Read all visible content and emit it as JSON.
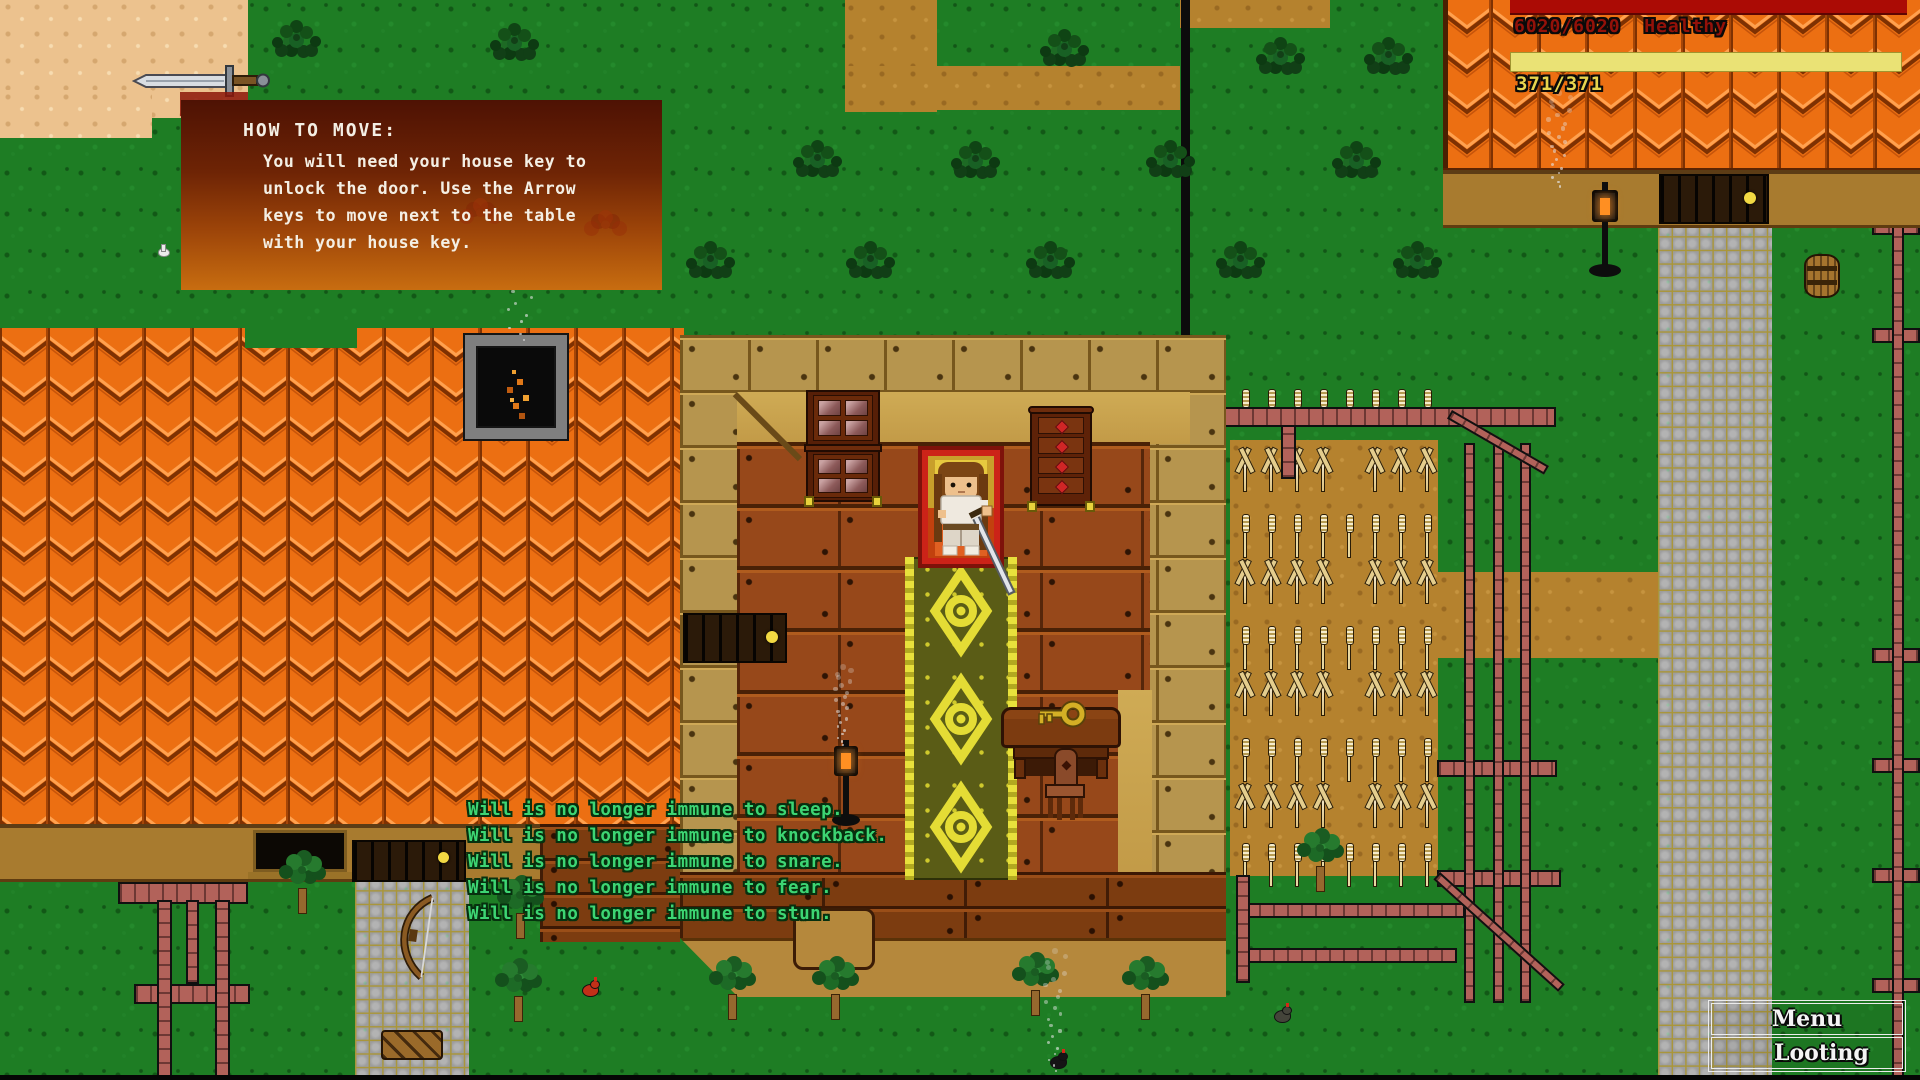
{
  "ui": {
    "tutorial": {
      "title": "HOW TO MOVE:",
      "lines": [
        "You will need your house key to",
        "unlock the door. Use the Arrow",
        "keys to move next to the table",
        "with your house key."
      ]
    },
    "vitals": {
      "health_value": "6020/6020",
      "health_label": "Healthy",
      "stamina_value": "371/371"
    },
    "messages": [
      "Will is no longer immune to sleep.",
      "Will is no longer immune to knockback.",
      "Will is no longer immune to snare.",
      "Will is no longer immune to fear.",
      "Will is no longer immune to stun."
    ],
    "buttons": {
      "menu": "Menu",
      "looting": "Looting"
    }
  },
  "colors": {
    "health_bar": "#ab0b05",
    "health_text": "#931109",
    "stamina_bar": "#eae275",
    "stamina_text": "#e7d44e",
    "message_text": "#3dd573",
    "roof_orange": "#ec6f12",
    "grass_green": "#1e7d24",
    "soil_brown": "#b5822e",
    "carpet_olive": "#5a5c16",
    "carpet_yellow": "#e4dc35"
  },
  "scene": {
    "bushes": [
      [
        296,
        37
      ],
      [
        514,
        40
      ],
      [
        1064,
        46
      ],
      [
        1280,
        54
      ],
      [
        1388,
        54
      ],
      [
        366,
        157
      ],
      [
        600,
        157
      ],
      [
        817,
        157
      ],
      [
        975,
        158
      ],
      [
        1170,
        157
      ],
      [
        1356,
        158
      ],
      [
        710,
        258
      ],
      [
        870,
        258
      ],
      [
        1050,
        258
      ],
      [
        1240,
        258
      ],
      [
        1417,
        258
      ]
    ],
    "trees": [
      [
        302,
        910
      ],
      [
        520,
        935
      ],
      [
        518,
        1018
      ],
      [
        732,
        1016
      ],
      [
        835,
        1016
      ],
      [
        1035,
        1012
      ],
      [
        1145,
        1016
      ],
      [
        1320,
        888
      ]
    ],
    "wheat": {
      "x0": 1243,
      "dx": 26,
      "cols": 8,
      "skip_col": 4,
      "sprout_rows": [
        448,
        560,
        672,
        784
      ],
      "stalk_rows": [
        516,
        628,
        740,
        845
      ],
      "head_row": 391
    },
    "smokes": [
      [
        517,
        210,
        135,
        50
      ],
      [
        1556,
        90,
        100,
        26
      ],
      [
        1052,
        948,
        128,
        24
      ],
      [
        840,
        664,
        84,
        18
      ]
    ],
    "fences_h": [
      [
        118,
        882,
        130,
        22
      ],
      [
        134,
        984,
        116,
        20
      ],
      [
        1208,
        407,
        348,
        20
      ],
      [
        1437,
        760,
        120,
        17
      ],
      [
        1437,
        870,
        124,
        17
      ],
      [
        1243,
        903,
        222,
        15
      ],
      [
        1243,
        948,
        214,
        15
      ],
      [
        1872,
        220,
        48,
        15
      ],
      [
        1872,
        328,
        48,
        15
      ],
      [
        1872,
        648,
        48,
        15
      ],
      [
        1872,
        758,
        48,
        15
      ],
      [
        1872,
        868,
        48,
        15
      ],
      [
        1872,
        978,
        48,
        15
      ]
    ],
    "fences_v": [
      [
        157,
        900,
        15,
        180
      ],
      [
        186,
        900,
        13,
        84
      ],
      [
        215,
        900,
        15,
        180
      ],
      [
        1281,
        425,
        15,
        54
      ],
      [
        1464,
        443,
        11,
        560
      ],
      [
        1493,
        443,
        11,
        560
      ],
      [
        1520,
        443,
        11,
        560
      ],
      [
        1195,
        875,
        14,
        108
      ],
      [
        1236,
        875,
        14,
        108
      ],
      [
        1892,
        222,
        12,
        858
      ]
    ],
    "fences_d": [
      [
        1452,
        410,
        112,
        10,
        30
      ],
      [
        1440,
        872,
        168,
        10,
        42
      ]
    ],
    "chickens": [
      [
        582,
        984,
        "#c23018"
      ],
      [
        1274,
        1010,
        "#44443a"
      ],
      [
        1050,
        1056,
        "#151515"
      ]
    ]
  }
}
